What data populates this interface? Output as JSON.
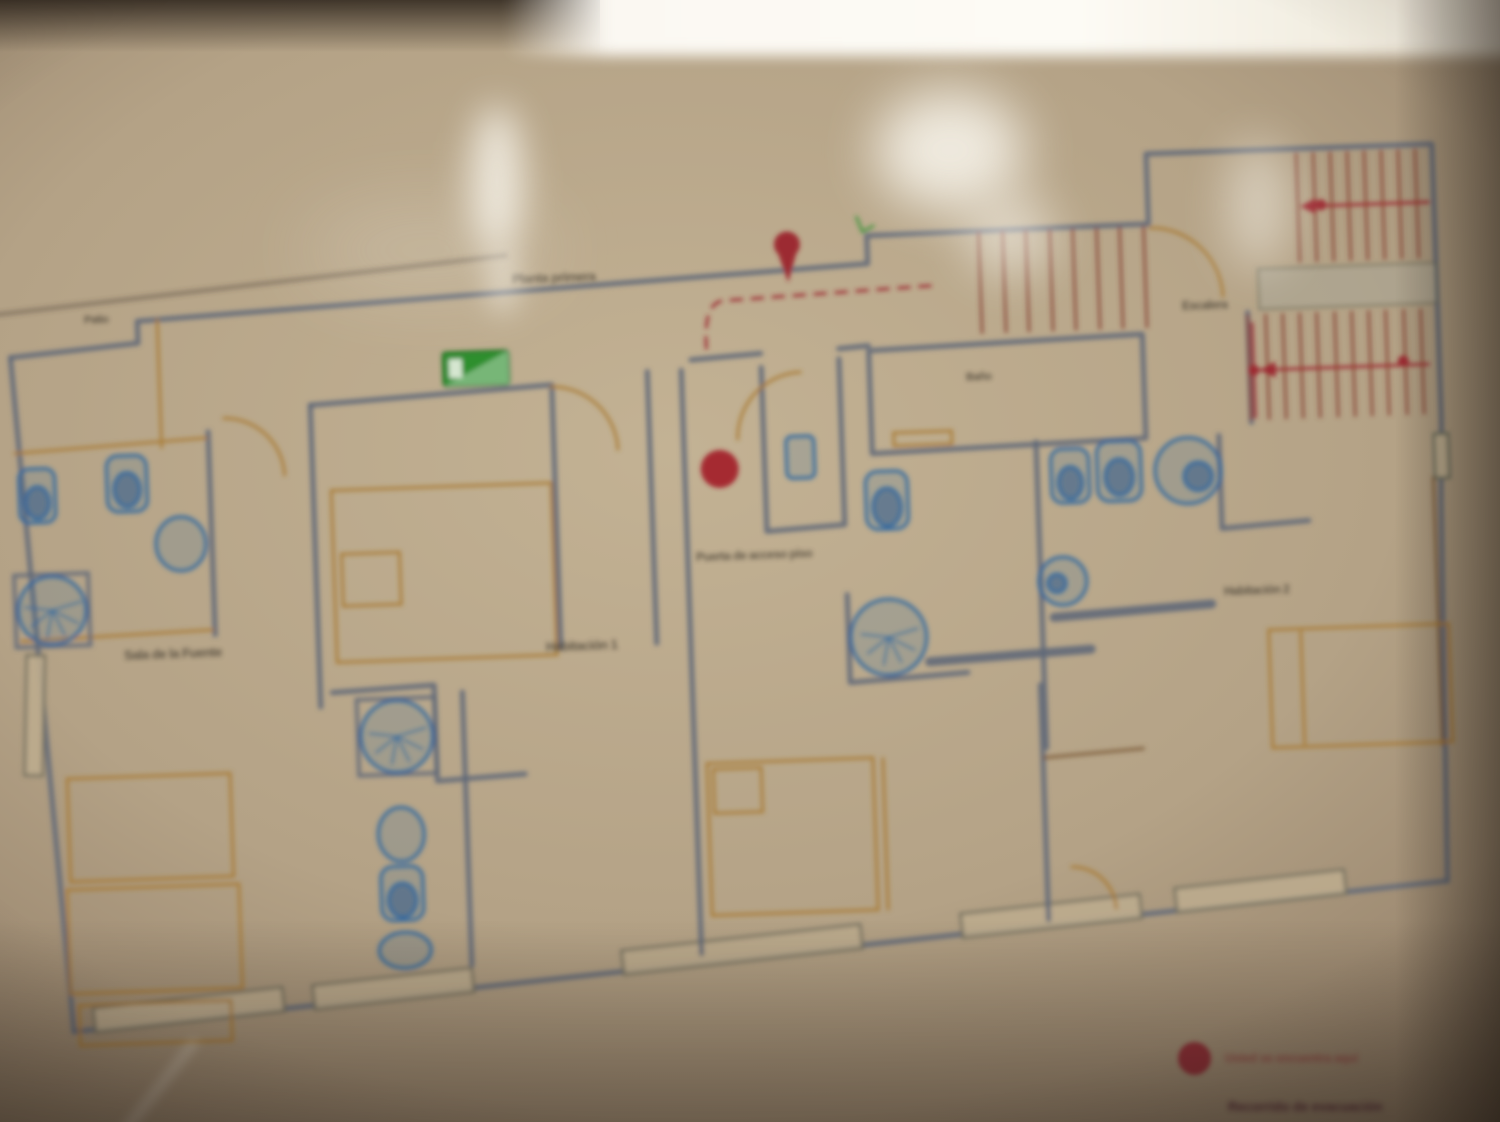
{
  "meta": {
    "description": "Blurry photograph of an emergency evacuation floor plan posted behind glass",
    "width": 1500,
    "height": 1122
  },
  "colors": {
    "photo_bg_center": "#c3b294",
    "photo_bg_edge": "#6f5f4c",
    "glare_white": "#fdfbf4",
    "wall": "#5f6878",
    "furniture_orange": "#a8782e",
    "fixture_blue": "#2e66a0",
    "route_red": "#9c2a30",
    "marker_red": "#a3242c",
    "exit_green": "#2f8f2f",
    "stair_tread": "#8a4a3a",
    "label_ink": "#453e33",
    "legend_red": "#8e2430"
  },
  "markers": {
    "you_are_here": {
      "x": 725,
      "y": 468,
      "r": 19
    },
    "route_pin": {
      "x": 800,
      "y": 262
    },
    "stair_dots": [
      {
        "x": 1335,
        "y": 225
      },
      {
        "x": 1262,
        "y": 388
      },
      {
        "x": 1412,
        "y": 384
      }
    ]
  },
  "exit_sign": {
    "icon": "emergency-exit-pictogram",
    "x": 452,
    "y": 342
  },
  "labels": [
    {
      "text": "Planta primera",
      "x": 512,
      "y": 270,
      "size": 13
    },
    {
      "text": "Patio",
      "x": 84,
      "y": 314,
      "size": 11
    },
    {
      "text": "Sala de la Fuente",
      "x": 124,
      "y": 646,
      "size": 13
    },
    {
      "text": "Habitación 1",
      "x": 546,
      "y": 638,
      "size": 13
    },
    {
      "text": "Puerta de acceso piso",
      "x": 696,
      "y": 548,
      "size": 12
    },
    {
      "text": "Baño",
      "x": 966,
      "y": 371,
      "size": 11
    },
    {
      "text": "Habitación 2",
      "x": 1224,
      "y": 583,
      "size": 12
    },
    {
      "text": "Escalera",
      "x": 1182,
      "y": 298,
      "size": 12
    }
  ],
  "legend": {
    "items": [
      {
        "symbol": "red-dot",
        "text": "Usted se encuentra aquí"
      },
      {
        "symbol": "red-bar",
        "text": "Recorrido de evacuación"
      }
    ]
  }
}
